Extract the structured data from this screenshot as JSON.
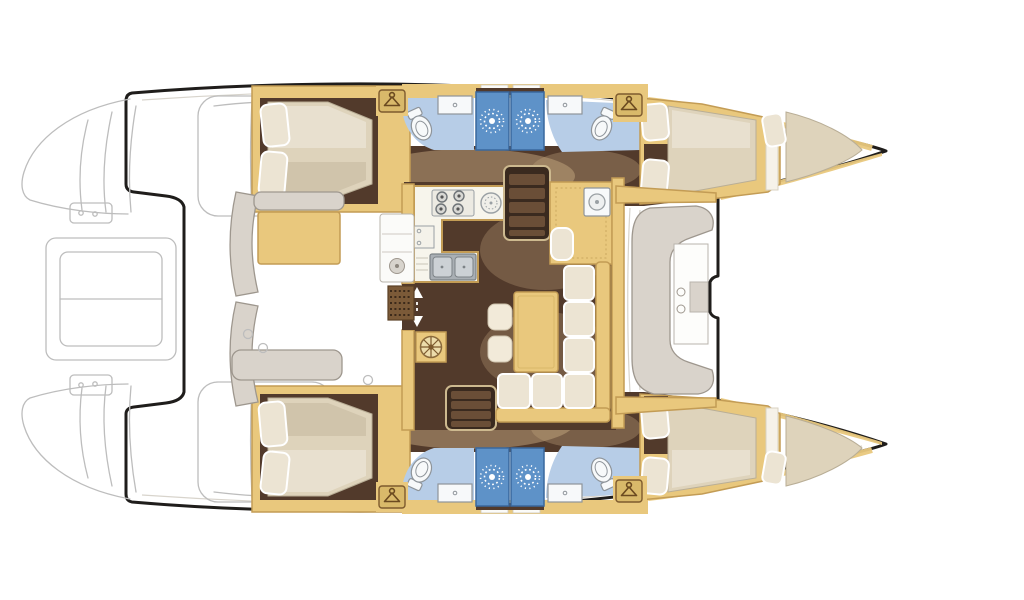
{
  "image": {
    "kind": "catamaran-yacht-floor-plan",
    "orientation": "bow-right-stern-left",
    "background": "#ffffff"
  },
  "palette": {
    "outline": "#1f1d1b",
    "sketch": "#bdbdbd",
    "sketch_light": "#d8d4cc",
    "paper": "#ffffff",
    "wood": "#e9c87d",
    "wood_dark": "#c39c55",
    "wood_deep": "#8a6a3c",
    "floor_dark": "#523a2b",
    "floor_glow": "#c3a57f",
    "mattress": "#ded3bb",
    "mattress_shade": "#c4b89e",
    "pillow": "#ece4d3",
    "bath_floor": "#b7cde7",
    "shower": "#5e92c8",
    "shower_dark": "#39689e",
    "fixture": "#f7f9fa",
    "fixture_line": "#8e949a",
    "bench": "#d9d3cb",
    "bench_line": "#9e978e",
    "counter": "#f7f5ec",
    "steel": "#a9afb4",
    "steel_light": "#ccd1d5",
    "hanger_plate": "#d9b96a",
    "hanger_line": "#6b4a20",
    "grate": "#7b5a38"
  },
  "inventory": {
    "hulls": 2,
    "double_cabins": 4,
    "bow_berths": 2,
    "bathrooms": 4,
    "shower_stalls": 4,
    "toilets": 4,
    "washbasins": 4,
    "wardrobe_lockers": 4,
    "stove_burners": 4,
    "galley_sinks": 3,
    "companionway_stairs": 2
  },
  "features": [
    "hull-silhouette",
    "transom-steps-sketch",
    "dinghy-davit-bay-sketch",
    "flybridge-sketch",
    "aft-cockpit",
    "cockpit-bench",
    "cockpit-grill-module",
    "saloon",
    "galley",
    "four-burner-stove",
    "round-sink",
    "double-sink",
    "oven",
    "chart-table",
    "companionway-stairs",
    "entry-door-arrows",
    "deck-grate",
    "floor-hatch",
    "dinette-sofa",
    "dining-table",
    "stool",
    "aft-cabin",
    "forward-cabin",
    "double-bed",
    "pillow",
    "bow-berth",
    "bathroom",
    "shower-stall",
    "shower-rose",
    "toilet",
    "washbasin",
    "wardrobe-locker",
    "forward-cockpit",
    "forward-cockpit-bench",
    "forward-cockpit-table",
    "trampoline-area",
    "deck-hatch"
  ]
}
